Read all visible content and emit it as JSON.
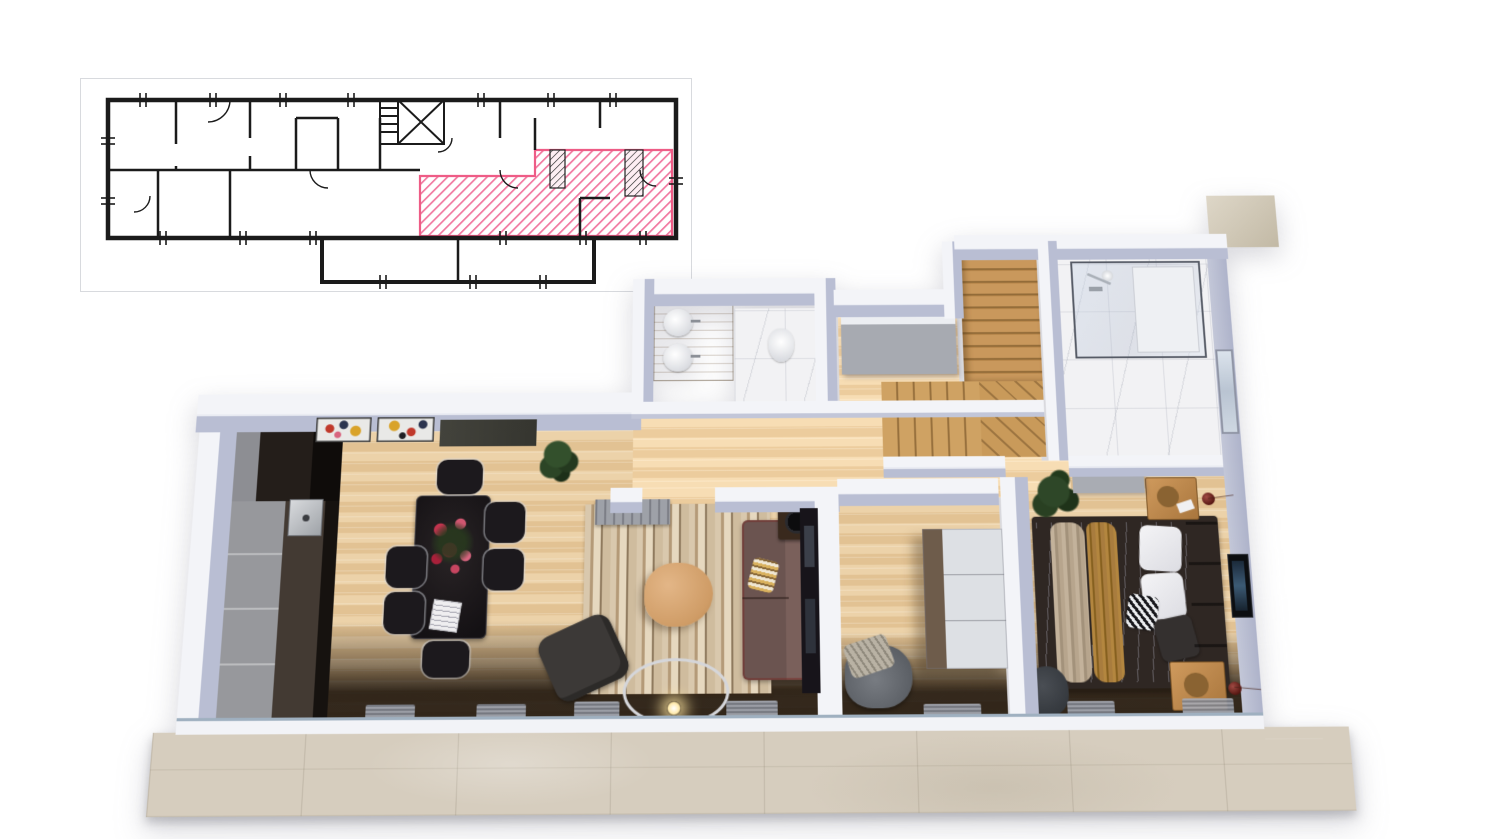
{
  "scene": {
    "type": "3d-apartment-floor-plan-render",
    "label": "Top-down 3D render of a furnished apartment",
    "background": "#ffffff"
  },
  "blueprint": {
    "label": "Building floor plan with highlighted unit",
    "paper_color": "#ffffff",
    "line_color": "#1b1b1b",
    "frame_color": "#d8dade",
    "highlight_color": "#ef5c87",
    "highlight_fill": "pink-diagonal-hatch",
    "symbols": [
      "stairwell-x",
      "stair-treads",
      "door-arcs",
      "window-ticks"
    ]
  },
  "palette": {
    "wall_top": "#f3f4f8",
    "wall_inner_face": "#b9bed3",
    "wood_floor": "#e8cda3",
    "marble": "#f2f2f4",
    "terrace": "#d6cdbe",
    "exterior_beige_wall": "#cbc2b0",
    "kitchen_dark": "#18130f",
    "kitchen_gray": "#97989c",
    "sofa": "#6e5550",
    "rug_tones": [
      "#d9c8ad",
      "#a98f6d",
      "#e6d8bf",
      "#8f7a5e"
    ],
    "stairs_wood": "#c49255",
    "bed_linen": "#e9e9ec",
    "throw_beige": "#b7a58d",
    "throw_caramel": "#a87c3e",
    "headboard": "#463931",
    "accent_lamp": "#7a2a22",
    "shower_glass_frame": "#565b66"
  },
  "rooms": {
    "living": {
      "label": "Open living / dining / kitchen",
      "furniture": [
        "kitchen cabinets",
        "sink",
        "dining table",
        "6 chairs",
        "flower centerpiece",
        "open book",
        "striped rug",
        "round coffee table",
        "sofa with striped pillow",
        "armchair",
        "arc floor lamp",
        "turntable stand",
        "bench",
        "two artworks",
        "dark wall panel",
        "potted plant",
        "doormats"
      ]
    },
    "corridor": {
      "label": "Hallway",
      "furniture": []
    },
    "bathroom_main": {
      "label": "Bathroom with double-sink vanity",
      "furniture": [
        "wood vanity",
        "two round sinks",
        "toilet"
      ]
    },
    "closet": {
      "label": "Storage / walk-in closet",
      "furniture": [
        "gray cabinets"
      ]
    },
    "staircase": {
      "label": "L-shaped wooden staircase",
      "furniture": [
        "upper flight",
        "diagonal landing"
      ]
    },
    "bathroom_shower": {
      "label": "Shower bathroom",
      "furniture": [
        "glass walk-in shower",
        "chrome fixtures",
        "window"
      ]
    },
    "kids_room": {
      "label": "Small room",
      "furniture": [
        "tall wardrobe",
        "pouf with fringed blanket",
        "doormat"
      ]
    },
    "bedroom": {
      "label": "Bedroom",
      "furniture": [
        "double bed",
        "beige throw",
        "caramel throw",
        "patterned pillow",
        "headboard",
        "two nightstands",
        "two red sphere lamps",
        "wall TV",
        "potted plant",
        "top cabinet",
        "gray pouf",
        "doormats"
      ]
    },
    "terrace": {
      "label": "Terrace walkway",
      "furniture": []
    }
  }
}
